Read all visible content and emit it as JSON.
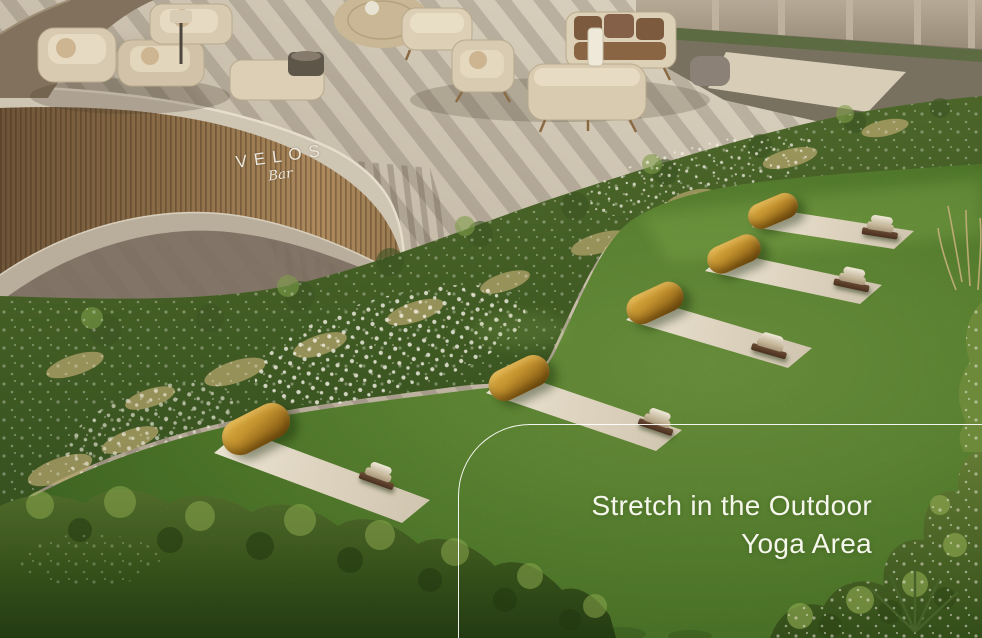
{
  "bar_sign": {
    "name": "VELOS",
    "subtitle": "Bar"
  },
  "caption": {
    "line1": "Stretch in the Outdoor",
    "line2": "Yoga Area"
  },
  "yoga_area": {
    "mat_count": 5
  },
  "colors": {
    "caption_text": "#f6f7ec",
    "divider_line": "#ffffff",
    "sign_text": "#ece8de",
    "lawn_green": "#6fa03c",
    "hedge_green": "#5d7c34",
    "tree_green": "#47661f",
    "mat_beige": "#ded4c0",
    "bolster_ochre": "#c2922e",
    "patio_stone": "#c9beac",
    "bar_wood": "#8a6c46",
    "wall_taupe": "#a89c89"
  }
}
